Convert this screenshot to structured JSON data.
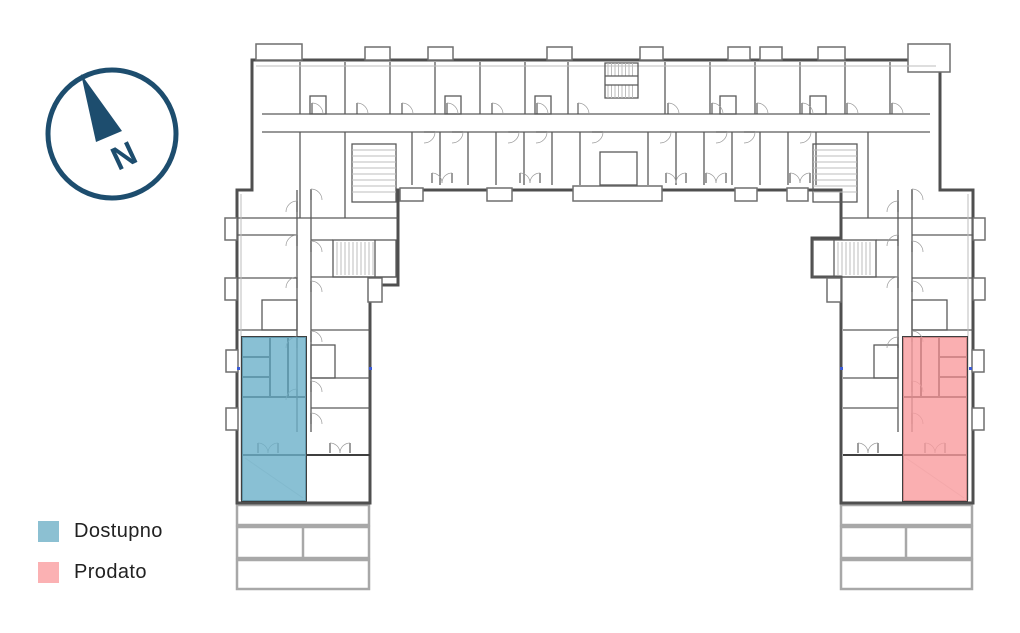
{
  "compass": {
    "label": "N",
    "color": "#1d4d6e"
  },
  "legend": {
    "items": [
      {
        "label": "Dostupno",
        "status": "available",
        "color": "#8cc0d2"
      },
      {
        "label": "Prodato",
        "status": "sold",
        "color": "#fbb1b3"
      }
    ]
  },
  "floorplan": {
    "wall_color": "#4f4f4f",
    "terrace_color": "#a8a8a8",
    "units": [
      {
        "status": "available",
        "wing": "left",
        "color": "#6cb0c9"
      },
      {
        "status": "sold",
        "wing": "right",
        "color": "#f99b9e"
      }
    ]
  }
}
